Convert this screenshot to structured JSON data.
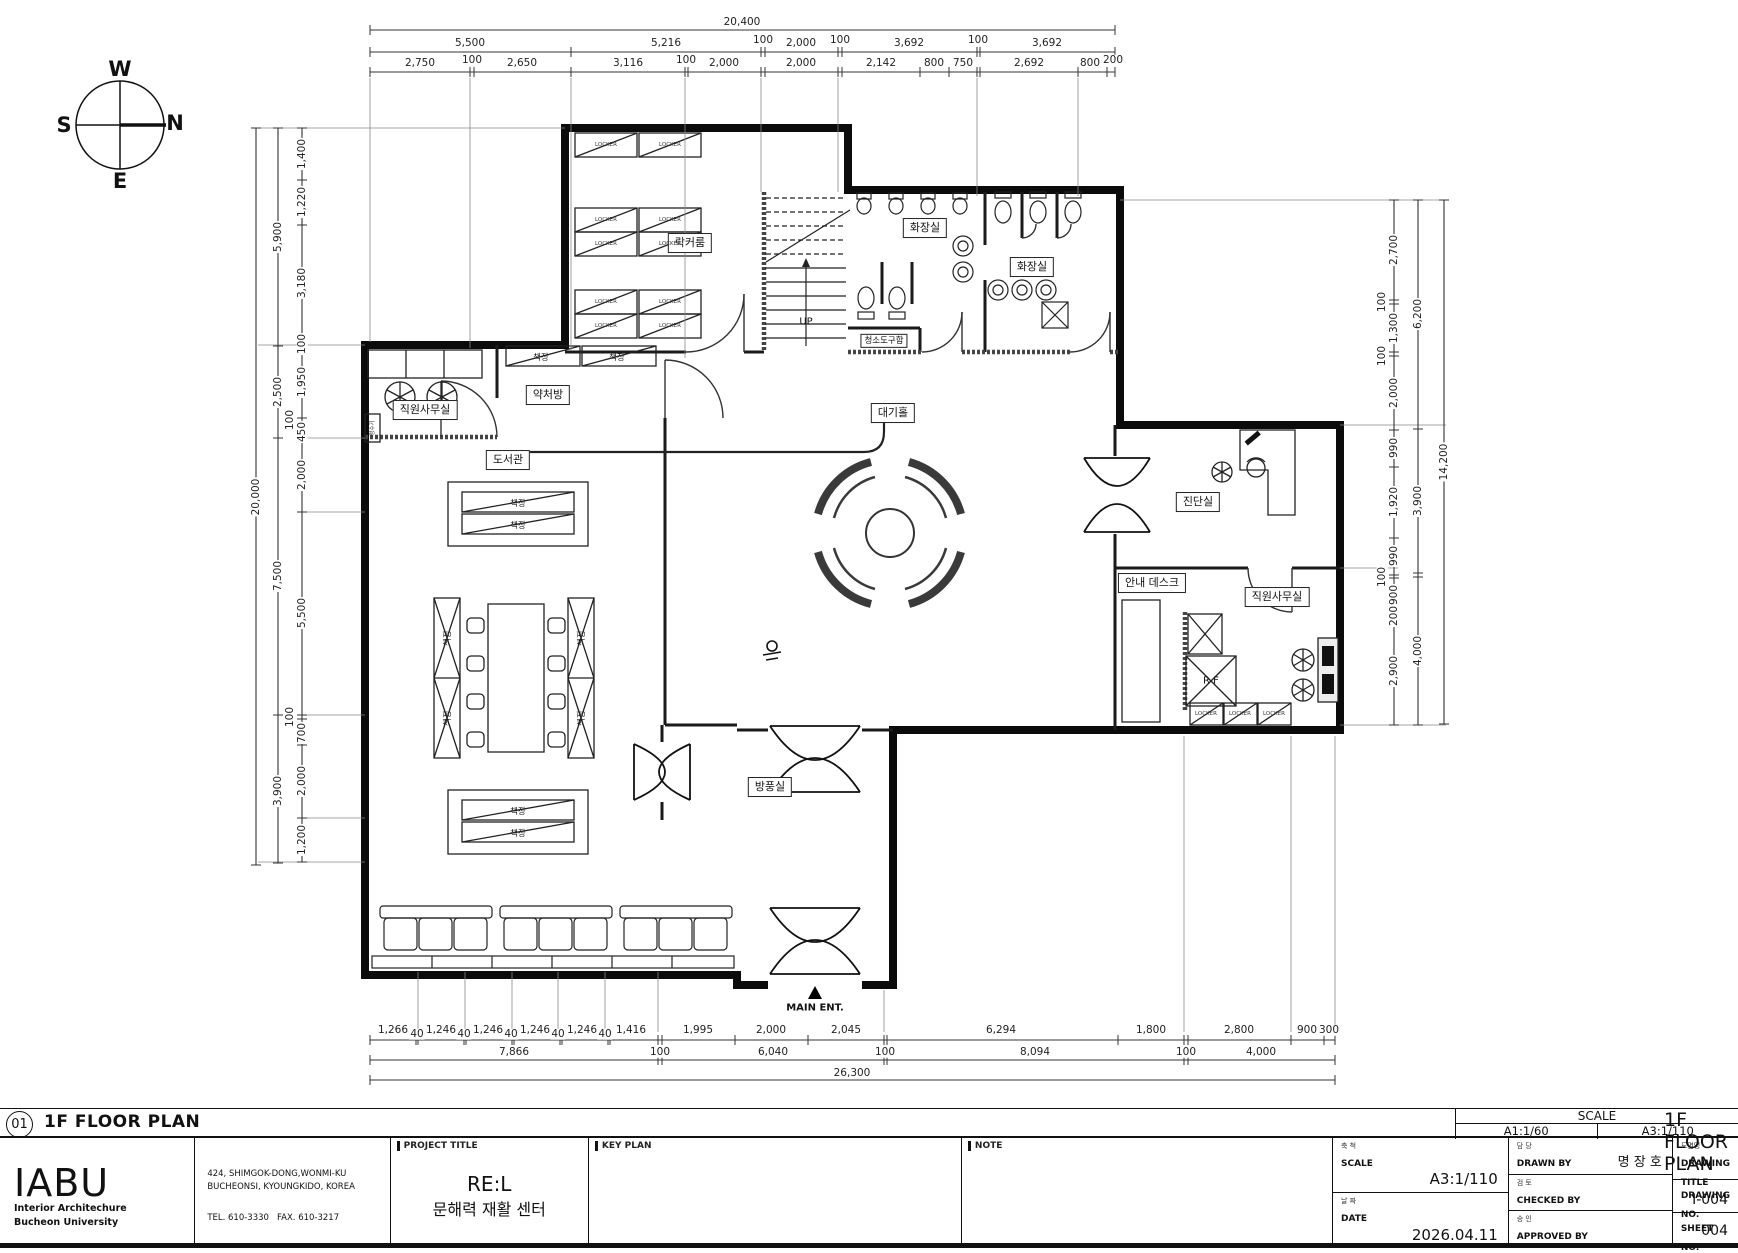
{
  "compass": {
    "top": "W",
    "right": "N",
    "left": "S",
    "bottom": "E"
  },
  "plan": {
    "rooms": {
      "locker_room": "락커룸",
      "toilet_1": "화장실",
      "toilet_2": "화장실",
      "cleaning_closet": "청소도구함",
      "waiting_hall": "대기홀",
      "staff_office_left": "직원사무실",
      "pharmacy": "약처방",
      "library": "도서관",
      "diagnosis_room": "진단실",
      "info_desk": "안내 데스크",
      "staff_office_right": "직원사무실",
      "windbreak_room": "방풍실"
    },
    "labels": {
      "up": "UP",
      "main_entrance": "MAIN ENT.",
      "locker": "LOCKER",
      "bookshelf": "책장",
      "ref": "R F",
      "water_purifier": "정수기"
    }
  },
  "dimensions": {
    "top": {
      "total": "20,400",
      "row2": [
        "5,500",
        "5,216",
        "100",
        "2,000",
        "100",
        "3,692",
        "100",
        "3,692"
      ],
      "row3": [
        "2,750",
        "100",
        "2,650",
        "3,116",
        "100",
        "2,000",
        "2,000",
        "2,142",
        "800",
        "750",
        "2,692",
        "800",
        "200"
      ]
    },
    "bottom": {
      "row1": [
        "1,266",
        "40",
        "1,246",
        "40",
        "1,246",
        "40",
        "1,246",
        "40",
        "1,246",
        "40",
        "1,416",
        "1,995",
        "2,000",
        "2,045",
        "6,294",
        "1,800",
        "2,800",
        "900",
        "300"
      ],
      "row2": [
        "7,866",
        "100",
        "6,040",
        "100",
        "8,094",
        "100",
        "4,000"
      ],
      "total": "26,300"
    },
    "left": {
      "outer": "20,000",
      "mid": [
        "5,900",
        "2,500",
        "7,500",
        "3,900"
      ],
      "inner": [
        "1,400",
        "1,220",
        "3,180",
        "100",
        "1,950",
        "100",
        "450",
        "2,000",
        "5,500",
        "100",
        "700",
        "2,000",
        "1,200"
      ]
    },
    "right": {
      "outer": "14,200",
      "mid": [
        "6,200",
        "3,900",
        "4,000"
      ],
      "inner": [
        "2,700",
        "100",
        "1,300",
        "100",
        "2,000",
        "990",
        "1,920",
        "990",
        "100",
        "900",
        "200",
        "2,900"
      ]
    }
  },
  "drawing_header": {
    "number": "01",
    "title": "1F FLOOR PLAN",
    "scale_label": "SCALE",
    "scale_a1": "A1:1/60",
    "scale_a3": "A3:1/110"
  },
  "title_block": {
    "logo_name": "IABU",
    "logo_sub1": "Interior Architechure",
    "logo_sub2": "Bucheon University",
    "address_line1": "424, SHIMGOK-DONG,WONMI-KU",
    "address_line2": "BUCHEONSI, KYOUNGKIDO, KOREA",
    "tel": "TEL. 610-3330",
    "fax": "FAX. 610-3217",
    "project_title_label": "PROJECT TITLE",
    "project_title_main": "RE:L",
    "project_title_sub": "문해력 재활 센터",
    "key_plan_label": "KEY PLAN",
    "note_label": "NOTE",
    "scale_kor": "축 척",
    "scale_label": "SCALE",
    "scale_value": "A3:1/110",
    "date_kor": "날 짜",
    "date_label": "DATE",
    "date_value": "2026.04.11",
    "drawn_kor": "담 당",
    "drawn_label": "DRAWN BY",
    "drawn_value": "명 장 호",
    "checked_kor": "검 토",
    "checked_label": "CHECKED BY",
    "checked_value": "",
    "approved_kor": "승 인",
    "approved_label": "APPROVED BY",
    "approved_value": "",
    "dtitle_kor": "도면명",
    "dtitle_label": "DRAWING TITLE",
    "dtitle_value": "1F FLOOR PLAN",
    "dno_label": "DRAWING NO.",
    "dno_value": "I-004",
    "sheet_label": "SHEET NO.",
    "sheet_value": "004"
  }
}
